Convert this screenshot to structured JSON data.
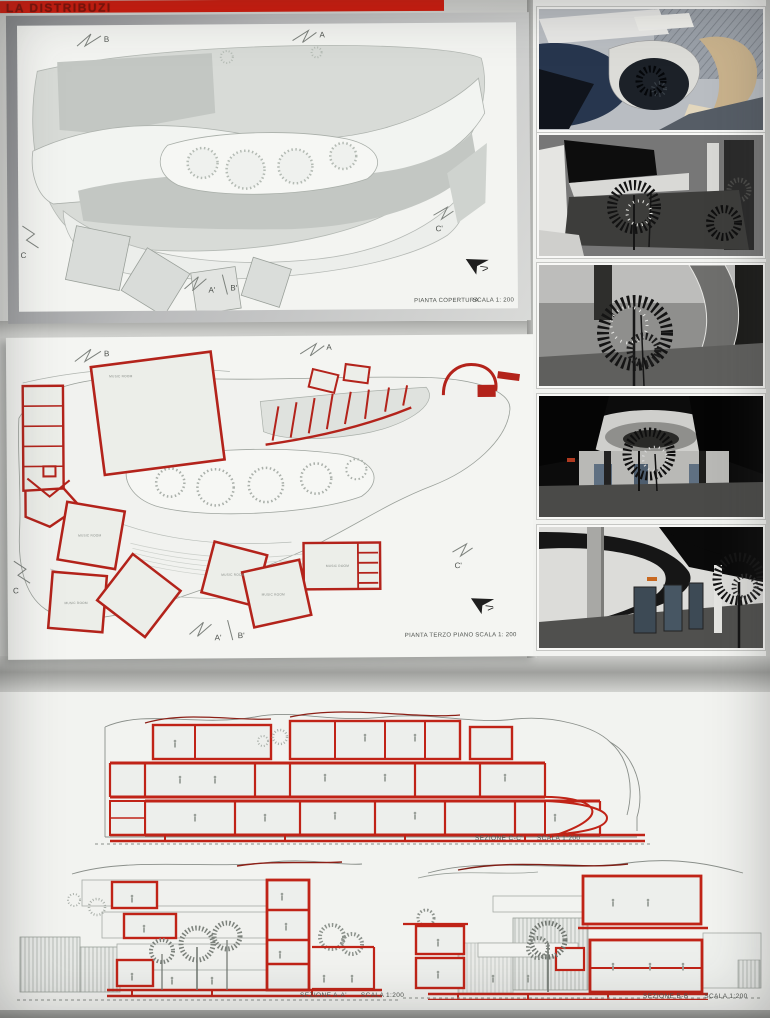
{
  "banner": {
    "text": "LA DISTRIBUZI"
  },
  "roof_plan": {
    "caption": {
      "title": "PIANTA COPERTURA",
      "scale": "SCALA 1: 200"
    },
    "markers": {
      "b": "B",
      "a": "A",
      "c": "C",
      "c_prime": "C'",
      "a_prime": "A'",
      "b_prime": "B'"
    }
  },
  "floor_plan": {
    "caption": {
      "title": "PIANTA TERZO PIANO",
      "scale": "SCALA 1: 200"
    },
    "markers": {
      "b": "B",
      "a": "A",
      "c": "C",
      "c_prime": "C'",
      "a_prime": "A'",
      "b_prime": "B'"
    },
    "room_label": "MUSIC ROOM"
  },
  "sections": {
    "cc": {
      "title": "SEZIONE C-C'",
      "scale": "SCALA 1:200"
    },
    "aa": {
      "title": "SEZIONE A-A'",
      "scale": "SCALA 1:200"
    },
    "bb": {
      "title": "SEZIONE B-B'",
      "scale": "SCALA 1:200"
    }
  },
  "colors": {
    "banner_red": "#d2180a",
    "drawing_red": "#b3231b"
  }
}
